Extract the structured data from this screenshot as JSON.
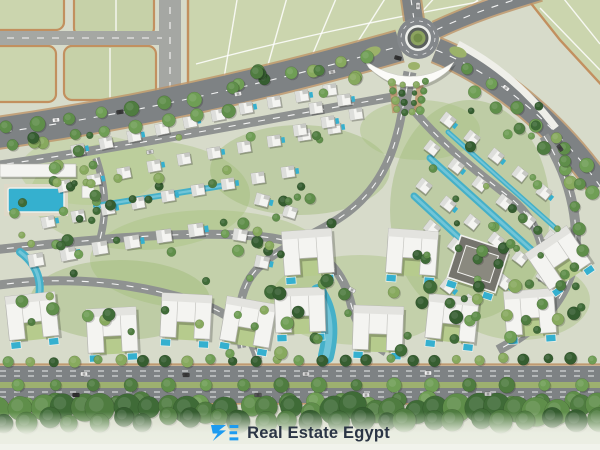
{
  "logo": {
    "text": "Real Estate Egypt",
    "mark_glyph": "RE",
    "mark_color": "#1d9bf0",
    "text_color": "#2b3545"
  },
  "palette": {
    "base": "#d7dbca",
    "parcel": "#cbd5ae",
    "parcel_alt": "#c6d1a8",
    "parcel_border": "#c2905f",
    "road_minor": "#a5a7a3",
    "road_major": "#7e8284",
    "road_internal": "#8f9291",
    "road_white": "#efefe9",
    "sidewalk_tan": "#bd9468",
    "median_green": "#9db06f",
    "water": "#45b0c8",
    "pool": "#35b0cf",
    "villa_roof": "#f4f4f1",
    "villa_dark": "#75746d",
    "tree_palette": [
      "#3f6b37",
      "#4f7c40",
      "#5f8e4a",
      "#6f9e55",
      "#87a95e",
      "#355d30"
    ],
    "fade": "#ecefe4"
  },
  "plan": {
    "gardens": [
      [
        140,
        195,
        110,
        55,
        "#a8c27f"
      ],
      [
        300,
        170,
        90,
        45,
        "#9cb873"
      ],
      [
        210,
        260,
        120,
        50,
        "#a8c27f"
      ],
      [
        470,
        210,
        80,
        110,
        "#9cb873"
      ],
      [
        360,
        300,
        90,
        45,
        "#a8c27f"
      ],
      [
        120,
        300,
        90,
        40,
        "#9cb873"
      ],
      [
        520,
        300,
        70,
        40,
        "#a8c27f"
      ],
      [
        90,
        170,
        70,
        35,
        "#b2ca8a"
      ],
      [
        420,
        130,
        60,
        30,
        "#a8c27f"
      ]
    ],
    "parcel_rects": [
      [
        -8,
        -8,
        72,
        38
      ],
      [
        74,
        -8,
        80,
        44
      ],
      [
        -8,
        46,
        64,
        56
      ],
      [
        64,
        46,
        92,
        54
      ]
    ],
    "parcel_polys": [
      "188,-8 512,-8 466,24 394,44 312,66 244,90 196,112 188,112",
      "522,-8 608,-8 608,92 560,40"
    ],
    "parcel_lines": [
      [
        238,
        -6,
        220,
        102
      ],
      [
        288,
        -6,
        262,
        86
      ],
      [
        338,
        -6,
        306,
        70
      ],
      [
        388,
        -6,
        350,
        54
      ],
      [
        438,
        -6,
        396,
        40
      ],
      [
        478,
        0,
        440,
        28
      ],
      [
        560,
        -6,
        600,
        44
      ],
      [
        540,
        8,
        600,
        70
      ],
      [
        116,
        -6,
        116,
        36
      ],
      [
        110,
        48,
        110,
        98
      ]
    ],
    "parcel_arcs": [
      "M196,64 C 300,36 400,16 500,-2"
    ],
    "roads_minor": [
      {
        "path": "M 170,-8 L 170,116",
        "w": 22
      },
      {
        "path": "M -8,38 L 162,38",
        "w": 14
      }
    ],
    "roads_major": [
      {
        "path": "M -10,134 C 120,116 260,86 400,46",
        "w": 30
      },
      {
        "path": "M 436,50 C 505,78 560,130 600,186",
        "w": 24
      },
      {
        "path": "M 414,20 L 410,-8",
        "w": 18
      },
      {
        "path": "M 436,30 C 470,14 500,4 540,-8",
        "w": 16
      }
    ],
    "roads_white": [
      {
        "path": "M 458,44 C 500,66 532,96 556,128",
        "w": 7
      }
    ],
    "roads_internal": [
      {
        "path": "M 544,136 C 572,180 584,232 570,276 C 558,310 532,332 498,350",
        "w": 10
      },
      {
        "path": "M -8,166 C 110,150 250,122 398,96",
        "w": 9
      },
      {
        "path": "M -8,250 C 90,240 200,228 272,238 C 322,246 342,270 350,300 C 356,326 368,342 386,352",
        "w": 9
      },
      {
        "path": "M 404,98 C 398,148 382,186 348,212 C 316,236 282,244 258,268 C 240,286 236,314 242,348",
        "w": 8.5
      },
      {
        "path": "M 404,98 C 434,138 472,168 508,196 C 536,218 548,248 542,282",
        "w": 8.5
      },
      {
        "path": "M 96,158 C 106,188 108,214 98,246",
        "w": 7.5
      },
      {
        "path": "M -8,286 C 70,274 140,284 196,302 C 234,314 252,334 258,360",
        "w": 9
      },
      {
        "path": "M 410,72 L 402,112",
        "w": 13
      }
    ],
    "entrance_medians": [
      [
        394,
        96,
        7,
        34,
        -6
      ],
      [
        419,
        95,
        7,
        34,
        6
      ]
    ],
    "canopy": "M 364,60 Q 410,92 454,62 L 449,70 Q 410,104 369,68 Z",
    "bottom_blvd": {
      "sidewalk_y": [
        364.5,
        403.5
      ],
      "carriage": [
        [
          366,
          16
        ],
        [
          388,
          15
        ]
      ],
      "median": [
        382,
        6
      ],
      "dash_y": [
        371,
        376,
        392,
        397
      ]
    },
    "roundabout": {
      "cx": 418,
      "cy": 38,
      "rings": [
        [
          21,
          "#83878a"
        ],
        [
          13,
          "#eef0ec"
        ],
        [
          10.5,
          "#5a5f5c"
        ],
        [
          7.5,
          "#8ca35f"
        ],
        [
          4.5,
          "#728c49"
        ]
      ],
      "lane_ring": 17,
      "islands": [
        [
          372,
          52,
          9,
          5,
          -20
        ],
        [
          458,
          52,
          9,
          5,
          20
        ],
        [
          414,
          66,
          6,
          4,
          0
        ]
      ]
    },
    "lagoons": [
      {
        "path": "M 96,206 C 150,197 200,190 232,184",
        "w": 6
      },
      {
        "path": "M 318,292 C 330,310 332,332 326,356",
        "w": 16
      },
      {
        "path": "M 430,158 L 545,262",
        "w": 7
      },
      {
        "path": "M 414,196 L 524,298",
        "w": 7
      },
      {
        "path": "M 448,132 L 560,232",
        "w": 5
      },
      {
        "path": "M 20,252 C 42,268 46,294 30,316",
        "w": 8
      }
    ],
    "clubhouse": {
      "building": [
        0,
        164,
        76,
        13
      ],
      "deck": [
        4,
        184,
        64,
        32
      ],
      "pool": [
        8,
        188,
        56,
        24
      ],
      "pavilion": [
        82,
        186,
        12,
        12
      ]
    },
    "villas_small": [
      [
        78,
        150,
        -12,
        1,
        1
      ],
      [
        106,
        143,
        -12,
        1,
        0
      ],
      [
        134,
        136,
        -11,
        1,
        1
      ],
      [
        162,
        129,
        -11,
        1,
        0
      ],
      [
        190,
        122,
        -10,
        1,
        1
      ],
      [
        218,
        115,
        -10,
        1,
        0
      ],
      [
        246,
        108,
        -10,
        1,
        1
      ],
      [
        274,
        102,
        -9,
        1,
        0
      ],
      [
        302,
        96,
        -9,
        1,
        1
      ],
      [
        330,
        90,
        -8,
        1,
        0
      ],
      [
        64,
        186,
        -12,
        1,
        0
      ],
      [
        94,
        180,
        -11,
        1,
        1
      ],
      [
        124,
        173,
        -11,
        1,
        0
      ],
      [
        154,
        166,
        -10,
        1,
        1
      ],
      [
        184,
        159,
        -10,
        1,
        0
      ],
      [
        214,
        153,
        -9,
        1,
        1
      ],
      [
        244,
        147,
        -9,
        1,
        0
      ],
      [
        274,
        141,
        -8,
        1,
        1
      ],
      [
        304,
        135,
        -8,
        1,
        0
      ],
      [
        334,
        128,
        -8,
        1,
        1
      ],
      [
        48,
        222,
        -11,
        1,
        1
      ],
      [
        78,
        216,
        -11,
        1,
        0
      ],
      [
        108,
        209,
        -10,
        1,
        1
      ],
      [
        138,
        203,
        -10,
        1,
        0
      ],
      [
        168,
        196,
        -9,
        1,
        1
      ],
      [
        198,
        190,
        -9,
        1,
        0
      ],
      [
        228,
        184,
        -8,
        1,
        1
      ],
      [
        258,
        178,
        -8,
        1,
        0
      ],
      [
        288,
        172,
        -8,
        1,
        1
      ],
      [
        36,
        260,
        -10,
        1.15,
        0
      ],
      [
        68,
        254,
        -10,
        1.15,
        1
      ],
      [
        100,
        248,
        -9,
        1.15,
        0
      ],
      [
        132,
        242,
        -9,
        1.15,
        1
      ],
      [
        164,
        236,
        -8,
        1.15,
        0
      ],
      [
        196,
        230,
        -8,
        1.15,
        1
      ],
      [
        316,
        108,
        -8,
        1,
        0
      ],
      [
        344,
        100,
        -8,
        1,
        1
      ],
      [
        300,
        130,
        -8,
        1,
        0
      ],
      [
        328,
        122,
        -8,
        1,
        1
      ],
      [
        356,
        114,
        -8,
        1,
        0
      ],
      [
        262,
        200,
        15,
        1.05,
        1
      ],
      [
        240,
        235,
        10,
        1.05,
        0
      ],
      [
        262,
        262,
        12,
        1.05,
        1
      ],
      [
        290,
        212,
        18,
        1,
        0
      ],
      [
        448,
        120,
        38,
        1,
        1
      ],
      [
        472,
        138,
        38,
        1,
        0
      ],
      [
        496,
        156,
        38,
        1,
        1
      ],
      [
        520,
        174,
        38,
        1,
        0
      ],
      [
        544,
        192,
        38,
        1,
        1
      ],
      [
        432,
        148,
        38,
        1,
        0
      ],
      [
        456,
        166,
        38,
        1,
        1
      ],
      [
        480,
        184,
        38,
        1,
        0
      ],
      [
        504,
        202,
        38,
        1,
        1
      ],
      [
        528,
        220,
        38,
        1,
        0
      ],
      [
        552,
        238,
        38,
        1,
        1
      ],
      [
        424,
        186,
        38,
        1,
        0
      ],
      [
        448,
        204,
        38,
        1,
        1
      ],
      [
        472,
        222,
        38,
        1,
        0
      ],
      [
        496,
        240,
        38,
        1,
        1
      ],
      [
        520,
        258,
        38,
        1,
        0
      ],
      [
        544,
        276,
        38,
        1,
        1
      ],
      [
        432,
        228,
        38,
        1.05,
        0
      ],
      [
        456,
        246,
        38,
        1.05,
        1
      ],
      [
        480,
        264,
        38,
        1.05,
        0
      ],
      [
        504,
        282,
        38,
        1.05,
        1
      ],
      [
        528,
        300,
        38,
        1.05,
        0
      ],
      [
        448,
        286,
        38,
        1,
        1
      ],
      [
        470,
        302,
        38,
        1,
        0
      ]
    ],
    "villas_large": [
      [
        32,
        316,
        -6,
        0
      ],
      [
        112,
        330,
        -3,
        0
      ],
      [
        186,
        316,
        3,
        0
      ],
      [
        248,
        322,
        10,
        0
      ],
      [
        300,
        310,
        -2,
        0
      ],
      [
        378,
        328,
        2,
        0
      ],
      [
        452,
        318,
        6,
        0
      ],
      [
        530,
        312,
        -4,
        0
      ],
      [
        308,
        252,
        -4,
        0
      ],
      [
        412,
        252,
        4,
        0
      ],
      [
        478,
        264,
        18,
        1
      ],
      [
        558,
        258,
        -34,
        0
      ]
    ],
    "tree_lines": [
      [
        6,
        127,
        196,
        99,
        7,
        6.5,
        1,
        2,
        21
      ],
      [
        12,
        146,
        230,
        112,
        8,
        6,
        2,
        2,
        22
      ],
      [
        240,
        86,
        365,
        58,
        6,
        5.5,
        3,
        2,
        23
      ],
      [
        468,
        66,
        585,
        166,
        6,
        6,
        2,
        3,
        24
      ],
      [
        474,
        90,
        590,
        190,
        6,
        6,
        1,
        3,
        25
      ],
      [
        565,
        160,
        582,
        250,
        5,
        5.5,
        2,
        2,
        26
      ],
      [
        575,
        270,
        510,
        338,
        5,
        5.5,
        1,
        3,
        27
      ],
      [
        392,
        82,
        396,
        110,
        4,
        3.5,
        2,
        1,
        28
      ],
      [
        426,
        82,
        420,
        110,
        4,
        3.5,
        2,
        1,
        29
      ],
      [
        402,
        84,
        404,
        112,
        4,
        3,
        4,
        1,
        30
      ],
      [
        416,
        84,
        412,
        112,
        4,
        3,
        4,
        1,
        31
      ],
      [
        18,
        385,
        582,
        385,
        16,
        6.5,
        1,
        0,
        32
      ],
      [
        8,
        361,
        592,
        359,
        27,
        5,
        3,
        1.5,
        33
      ],
      [
        0,
        404,
        600,
        402,
        22,
        8,
        1,
        3,
        34
      ],
      [
        0,
        410,
        600,
        408,
        30,
        12,
        0,
        4,
        35
      ],
      [
        0,
        420,
        600,
        419,
        26,
        10,
        5,
        4,
        36
      ]
    ],
    "tree_clusters": [
      [
        30,
        135,
        350,
        120,
        45,
        3,
        6,
        7
      ],
      [
        400,
        105,
        185,
        230,
        34,
        3,
        6,
        11
      ],
      [
        15,
        255,
        570,
        100,
        48,
        3.5,
        7,
        3
      ],
      [
        0,
        150,
        110,
        100,
        14,
        3,
        6,
        9
      ],
      [
        220,
        70,
        150,
        30,
        8,
        4,
        7,
        5
      ]
    ],
    "cars": [
      [
        56,
        120,
        -6,
        "#f5f5f5"
      ],
      [
        120,
        112,
        -8,
        "#3a3a3a"
      ],
      [
        238,
        94,
        -11,
        "#e8e8e8"
      ],
      [
        332,
        72,
        -13,
        "#cfcfcf"
      ],
      [
        506,
        88,
        38,
        "#f0f0f0"
      ],
      [
        560,
        148,
        55,
        "#444444"
      ],
      [
        418,
        6,
        90,
        "#dddddd"
      ],
      [
        398,
        58,
        15,
        "#333333"
      ],
      [
        84,
        374,
        0,
        "#e9e9e9"
      ],
      [
        186,
        375,
        0,
        "#3d3d3d"
      ],
      [
        306,
        374,
        0,
        "#d8d8d8"
      ],
      [
        428,
        373,
        0,
        "#f2f2f2"
      ],
      [
        76,
        395,
        0,
        "#2f2f2f"
      ],
      [
        258,
        395,
        0,
        "#555555"
      ],
      [
        366,
        395,
        0,
        "#e5e5e5"
      ],
      [
        488,
        394,
        0,
        "#cfcfcf"
      ],
      [
        150,
        152,
        -10,
        "#dadada"
      ],
      [
        352,
        290,
        30,
        "#eaeaea"
      ]
    ]
  }
}
